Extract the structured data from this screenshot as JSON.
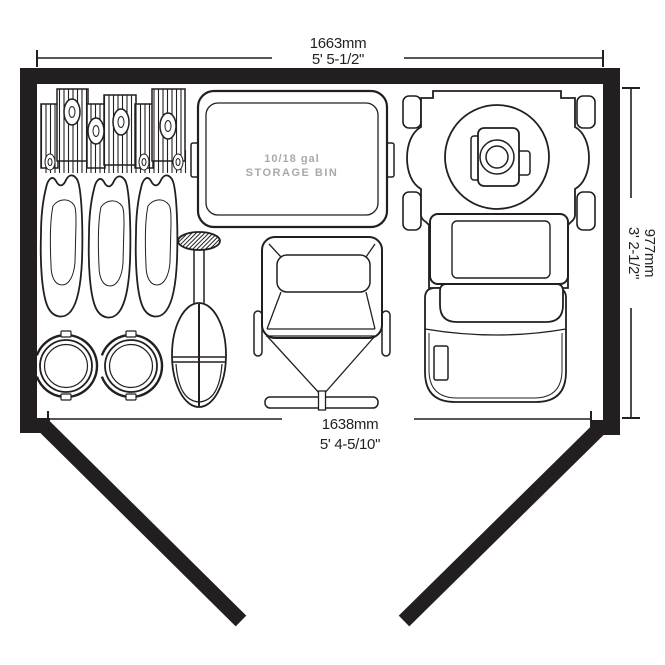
{
  "floor_plan": {
    "background": "#ffffff",
    "wall_color": "#231f20",
    "line_color": "#231f20",
    "dim_top": {
      "metric": "1663mm",
      "imperial": "5' 5-1/2\""
    },
    "dim_bottom": {
      "metric": "1638mm",
      "imperial": "5' 4-5/10\""
    },
    "dim_right": {
      "metric": "977mm",
      "imperial": "3' 2-1/2\""
    },
    "bin_label": {
      "line1": "10/18 gal",
      "line2": "STORAGE BIN",
      "color": "#a7a9ac"
    },
    "items": [
      "tool-rack",
      "spade-blades",
      "bucket-reels",
      "scoop-tool",
      "folding-chair",
      "lawn-mower",
      "open-doors"
    ]
  }
}
